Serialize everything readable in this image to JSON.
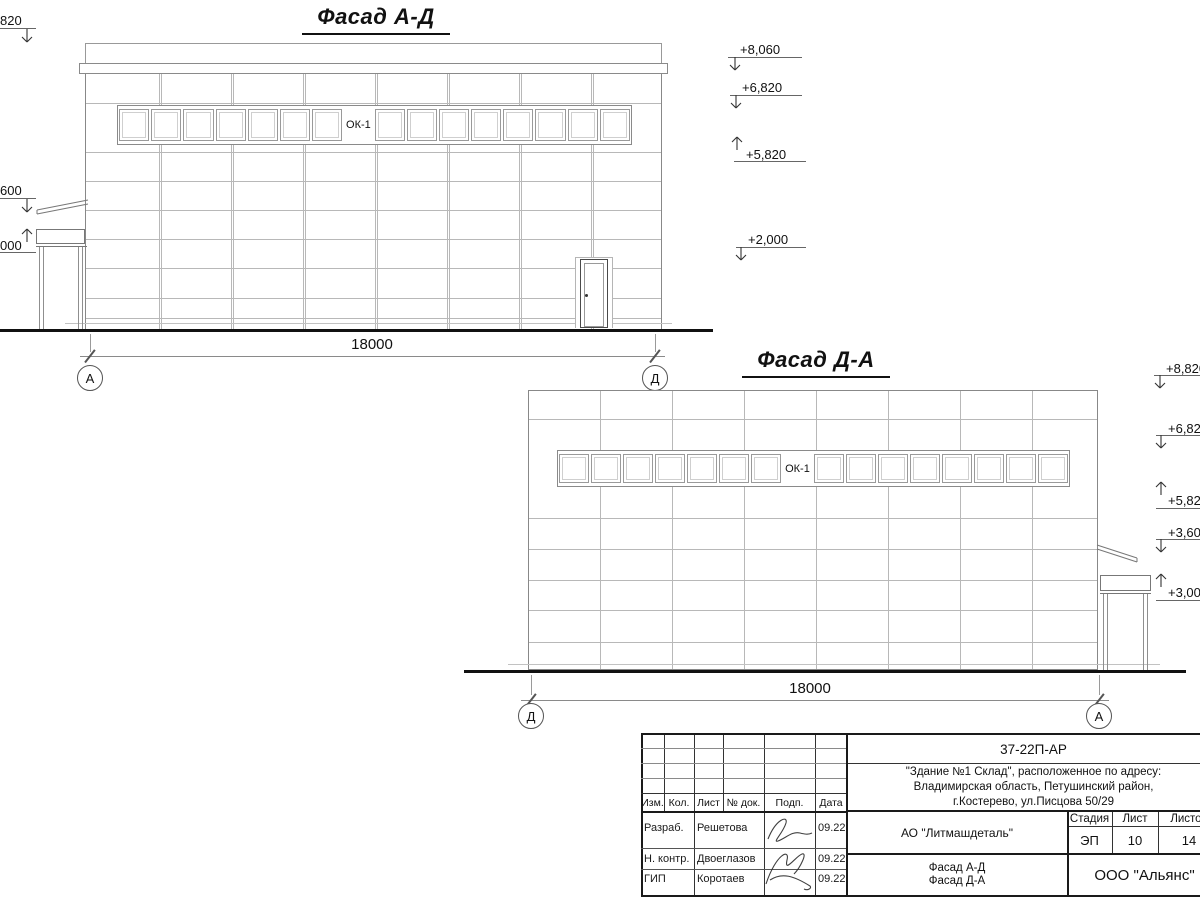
{
  "page": {
    "background": "#ffffff",
    "main_line_color": "#3c3c3c",
    "grid_line_color": "#b8b8b8",
    "accent_black": "#111111"
  },
  "facade_ad": {
    "title": "Фасад А-Д",
    "window_band_label": "ОК-1",
    "window_sections": 16,
    "dimension_label": "18000",
    "axis_start": "А",
    "axis_end": "Д",
    "elevation_marks_right": [
      "+8,060",
      "+6,820",
      "+5,820",
      "+2,000"
    ],
    "elevation_marks_left": [
      "820",
      "600",
      "000"
    ]
  },
  "facade_da": {
    "title": "Фасад Д-А",
    "window_band_label": "ОК-1",
    "window_sections": 16,
    "dimension_label": "18000",
    "axis_start": "Д",
    "axis_end": "А",
    "elevation_marks_right": [
      "+8,820",
      "+6,820",
      "+5,820",
      "+3,600",
      "+3,000"
    ]
  },
  "title_block": {
    "doc_number": "37-22П-АР",
    "project_lines": [
      "\"Здание №1 Склад\", расположенное по адресу:",
      "Владимирская область, Петушинский район,",
      "г.Костерево, ул.Писцова 50/29"
    ],
    "table_headers": [
      "Изм.",
      "Кол.",
      "Лист",
      "№ док.",
      "Подп.",
      "Дата"
    ],
    "signature_rows": [
      {
        "role": "Разраб.",
        "name": "Решетова",
        "date": "09.22"
      },
      {
        "role": "Н. контр.",
        "name": "Двоеглазов",
        "date": "09.22"
      },
      {
        "role": "ГИП",
        "name": "Коротаев",
        "date": "09.22"
      }
    ],
    "client": "АО \"Литмашдеталь\"",
    "stage_label": "Стадия",
    "sheet_label": "Лист",
    "sheets_label": "Листов",
    "stage_value": "ЭП",
    "sheet_value": "10",
    "sheets_value": "14",
    "sheet_content_lines": [
      "Фасад А-Д",
      "Фасад Д-А"
    ],
    "company": "ООО \"Альянс\""
  }
}
